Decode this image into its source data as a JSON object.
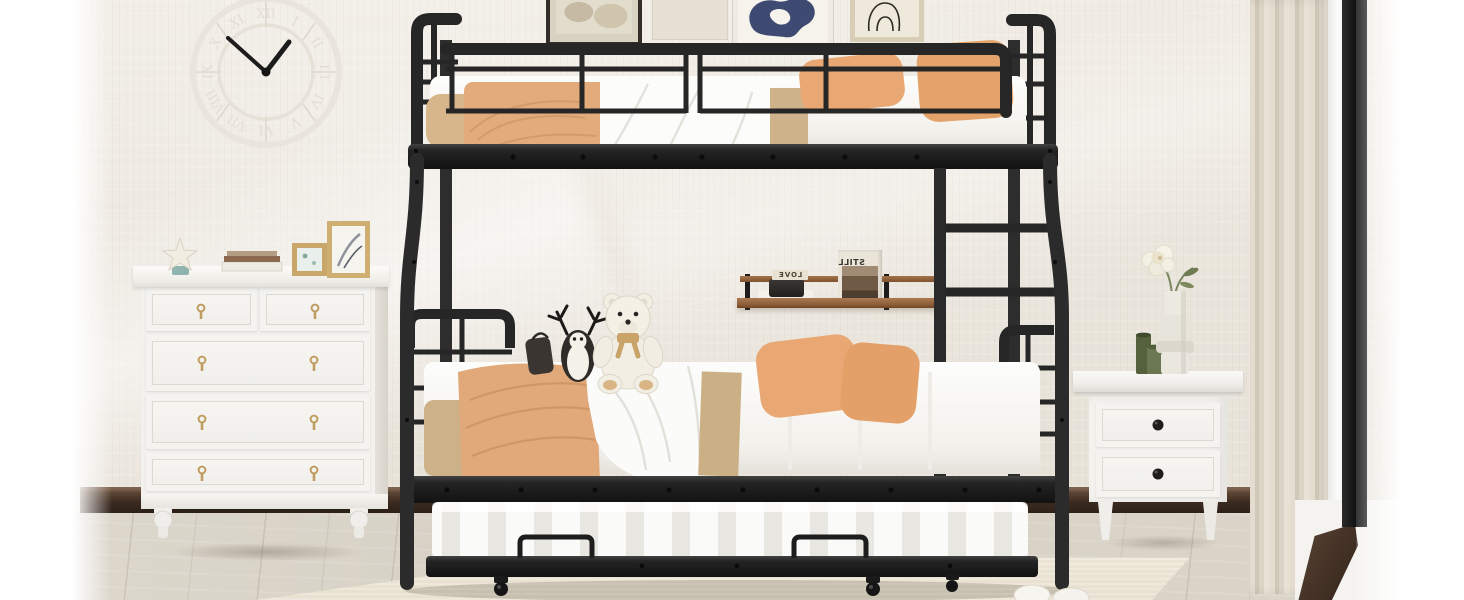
{
  "scene": {
    "description": "Bright bedroom product photo: black metal twin-over-full bunk bed with pull-out trundle, white dresser, wall clock, floating shelf, white nightstand with flowers, window light at right",
    "palette": {
      "wall": "#ebe6dd",
      "baseboard": "#3c2b20",
      "floor": "#d9d3c7",
      "rug": "#eae3d3",
      "metal_frame": "#262626",
      "pillow_orange": "#e7a671",
      "blanket_tan": "#e0a97b",
      "sheet_khaki": "#cbb088",
      "linen_white": "#fbfaf8",
      "furniture_white": "#f4f3ef",
      "shelf_wood": "#9a6b44",
      "curtain": "#d8d1c3",
      "drawer_pull_gold": "#bf9d61"
    },
    "clock": {
      "style": "roman-numeral skeleton wall clock",
      "numerals": [
        "XII",
        "I",
        "II",
        "III",
        "IV",
        "V",
        "VI",
        "VII",
        "VIII",
        "IX",
        "X",
        "XI"
      ]
    },
    "shelf": {
      "magazine_title": "STILL",
      "letter_blocks": "LOVE"
    },
    "objects": [
      "wall-clock",
      "art-frames",
      "white-dresser",
      "starfish-decor",
      "book-stack",
      "photo-frames",
      "bunk-bed",
      "ladder",
      "guardrail",
      "upper-mattress",
      "lower-mattress",
      "trundle-bed",
      "teddy-bear",
      "penguin-plush",
      "floating-shelf",
      "nightstand",
      "flower-vase",
      "curtain",
      "window",
      "slippers",
      "area-rug"
    ]
  }
}
